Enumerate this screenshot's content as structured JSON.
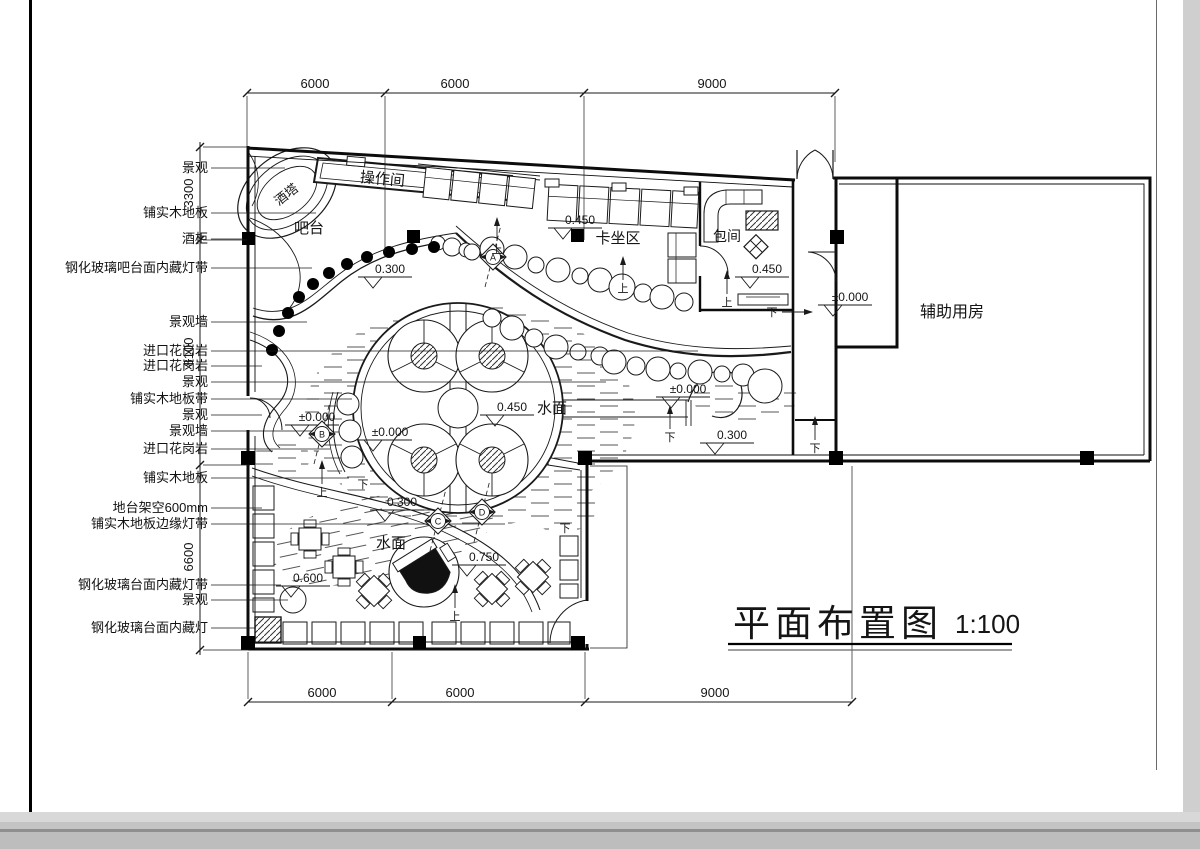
{
  "page": {
    "background": "#c8c8c8",
    "sheet": "#ffffff",
    "line_color": "#1a1a1a"
  },
  "title_block": {
    "title": "平面布置图",
    "scale": "1:100"
  },
  "plan_labels": [
    {
      "text": "酒塔",
      "x": 289,
      "y": 198,
      "rotate": -38,
      "size": 13
    },
    {
      "text": "操作间",
      "x": 382,
      "y": 184,
      "rotate": 5,
      "size": 15
    },
    {
      "text": "吧台",
      "x": 309,
      "y": 233,
      "rotate": 0,
      "size": 15
    },
    {
      "text": "卡坐区",
      "x": 618,
      "y": 243,
      "rotate": 0,
      "size": 15
    },
    {
      "text": "包间",
      "x": 727,
      "y": 241,
      "rotate": 0,
      "size": 14
    },
    {
      "text": "辅助用房",
      "x": 952,
      "y": 317,
      "rotate": 0,
      "size": 16
    },
    {
      "text": "水面",
      "x": 552,
      "y": 413,
      "rotate": 0,
      "size": 15
    },
    {
      "text": "水面",
      "x": 391,
      "y": 548,
      "rotate": 0,
      "size": 15
    }
  ],
  "callouts": [
    {
      "text": "景观",
      "y": 168,
      "ex": 285
    },
    {
      "text": "铺实木地板",
      "y": 213,
      "ex": 316
    },
    {
      "text": "酒柜",
      "y": 239,
      "ex": 243
    },
    {
      "text": "钢化玻璃吧台面内藏灯带",
      "y": 268,
      "ex": 312
    },
    {
      "text": "景观墙",
      "y": 322,
      "ex": 307
    },
    {
      "text": "进口花岗岩",
      "y": 351,
      "ex": 698
    },
    {
      "text": "进口花岗岩",
      "y": 366,
      "ex": 262
    },
    {
      "text": "景观",
      "y": 382,
      "ex": 606
    },
    {
      "text": "铺实木地板带",
      "y": 399,
      "ex": 352
    },
    {
      "text": "景观",
      "y": 415,
      "ex": 262
    },
    {
      "text": "景观墙",
      "y": 431,
      "ex": 313
    },
    {
      "text": "进口花岗岩",
      "y": 449,
      "ex": 330
    },
    {
      "text": "铺实木地板",
      "y": 478,
      "ex": 349
    },
    {
      "text": "地台架空600mm",
      "y": 508,
      "ex": 262
    },
    {
      "text": "铺实木地板边缘灯带",
      "y": 524,
      "ex": 505
    },
    {
      "text": "钢化玻璃台面内藏灯带",
      "y": 585,
      "ex": 281
    },
    {
      "text": "景观",
      "y": 600,
      "ex": 288
    },
    {
      "text": "钢化玻璃台面内藏灯",
      "y": 628,
      "ex": 256
    }
  ],
  "dims": {
    "top": {
      "y": 93,
      "ticks": [
        247,
        385,
        584,
        835
      ],
      "labels": [
        {
          "t": "6000",
          "p": 315
        },
        {
          "t": "6000",
          "p": 455
        },
        {
          "t": "9000",
          "p": 712
        }
      ],
      "ext": [
        [
          247,
          148
        ],
        [
          385,
          252
        ],
        [
          584,
          240
        ],
        [
          835,
          162
        ]
      ]
    },
    "bottom": {
      "y": 702,
      "ticks": [
        248,
        392,
        585,
        852
      ],
      "labels": [
        {
          "t": "6000",
          "p": 322
        },
        {
          "t": "6000",
          "p": 460
        },
        {
          "t": "9000",
          "p": 715
        }
      ],
      "ext": [
        [
          248,
          652
        ],
        [
          392,
          652
        ],
        [
          585,
          652
        ],
        [
          852,
          466
        ]
      ]
    },
    "left": {
      "x": 200,
      "ticks": [
        147,
        240,
        465,
        650
      ],
      "labels": [
        {
          "t": "3300",
          "p": 193
        },
        {
          "t": "8100",
          "p": 352
        },
        {
          "t": "6600",
          "p": 557
        }
      ],
      "ext": [
        [
          147,
          247
        ],
        [
          240,
          247
        ],
        [
          465,
          250
        ],
        [
          650,
          250
        ]
      ]
    }
  },
  "elevations": [
    {
      "t": "±0.000",
      "x": 285,
      "y": 425
    },
    {
      "t": "±0.000",
      "x": 358,
      "y": 440
    },
    {
      "t": "0.450",
      "x": 480,
      "y": 415
    },
    {
      "t": "±0.000",
      "x": 656,
      "y": 397
    },
    {
      "t": "0.300",
      "x": 700,
      "y": 443
    },
    {
      "t": "±0.000",
      "x": 818,
      "y": 305
    },
    {
      "t": "0.450",
      "x": 548,
      "y": 228
    },
    {
      "t": "0.450",
      "x": 735,
      "y": 277
    },
    {
      "t": "0.300",
      "x": 358,
      "y": 277
    },
    {
      "t": "0.300",
      "x": 370,
      "y": 510
    },
    {
      "t": "0.750",
      "x": 452,
      "y": 565
    },
    {
      "t": "0.600",
      "x": 276,
      "y": 586
    }
  ],
  "section_markers": [
    {
      "l": "A",
      "x": 493,
      "y": 257
    },
    {
      "l": "B",
      "x": 322,
      "y": 434
    },
    {
      "l": "C",
      "x": 438,
      "y": 521
    },
    {
      "l": "D",
      "x": 482,
      "y": 512
    }
  ],
  "stair_marks": [
    {
      "t": "上",
      "x": 623,
      "y": 292,
      "d": "up"
    },
    {
      "t": "上",
      "x": 727,
      "y": 306,
      "d": "up"
    },
    {
      "t": "上",
      "x": 322,
      "y": 496,
      "d": "up"
    },
    {
      "t": "上",
      "x": 455,
      "y": 620,
      "d": "up"
    },
    {
      "t": "上",
      "x": 497,
      "y": 253,
      "d": "up"
    },
    {
      "t": "下",
      "x": 772,
      "y": 316,
      "d": "right"
    },
    {
      "t": "下",
      "x": 815,
      "y": 452,
      "d": "up"
    },
    {
      "t": "下",
      "x": 670,
      "y": 441,
      "d": "up"
    },
    {
      "t": "下",
      "x": 565,
      "y": 532,
      "d": "none"
    },
    {
      "t": "下",
      "x": 363,
      "y": 488,
      "d": "none"
    }
  ]
}
